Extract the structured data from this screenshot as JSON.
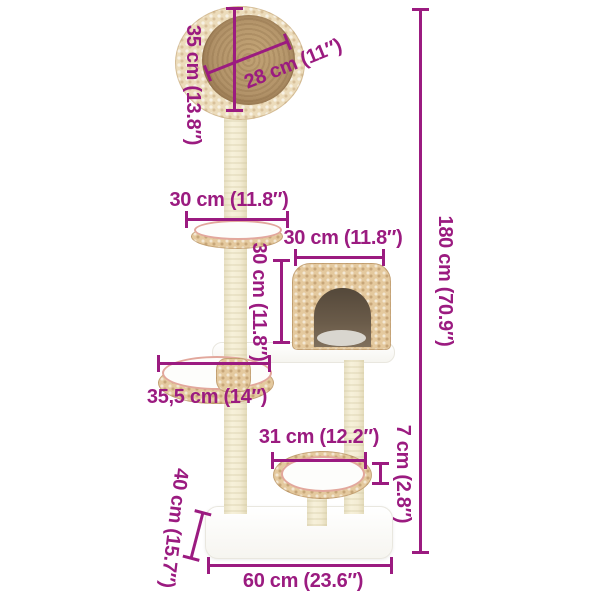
{
  "diagram": {
    "accent_color": "#9b1b80",
    "measurements": {
      "top_basket_height": "35 cm (13.8″)",
      "top_basket_diameter": "28 cm (11″)",
      "upper_platform_width": "30 cm (11.8″)",
      "condo_width": "30 cm (11.8″)",
      "condo_height": "30 cm (11.8″)",
      "total_height": "180 cm (70.9″)",
      "middle_platform_width": "35,5 cm (14″)",
      "lower_basket_width": "31 cm (12.2″)",
      "lower_basket_rim_height": "7 cm (2.8″)",
      "base_depth": "40 cm (15.7″)",
      "base_width": "60 cm (23.6″)"
    },
    "colors": {
      "dimension_text": "#9b1b80",
      "weave": "#e4c99e",
      "weave_light": "#ecdcbb",
      "basket_interior": "#b3946a",
      "pink_trim": "#e2a79c",
      "post": "#f3ecd3",
      "white_parts": "#fdfdfb"
    }
  }
}
